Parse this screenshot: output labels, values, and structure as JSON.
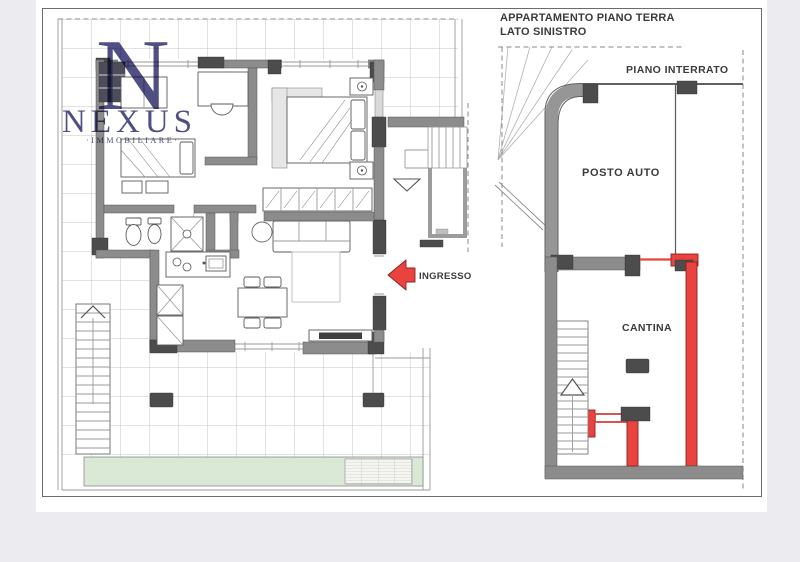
{
  "page": {
    "background": "#ecebf0",
    "paper": "#ffffff"
  },
  "titles": {
    "left_plan_line1": "APPARTAMENTO PIANO TERRA",
    "left_plan_line2": "LATO SINISTRO",
    "right_plan": "PIANO INTERRATO"
  },
  "labels": {
    "parking": "POSTO AUTO",
    "cellar": "CANTINA",
    "entrance": "INGRESSO"
  },
  "watermark": {
    "monogram": "N",
    "brand": "NEXUS",
    "tagline": "·IMMOBILIARE·",
    "color": "#30306e"
  },
  "colors": {
    "wall_gray": "#8c8c8c",
    "pillar_dark": "#4c4c4c",
    "highlight_red": "#e8433f",
    "garden_green": "#d9e9d6",
    "tile_grid": "#c6c6c6"
  }
}
